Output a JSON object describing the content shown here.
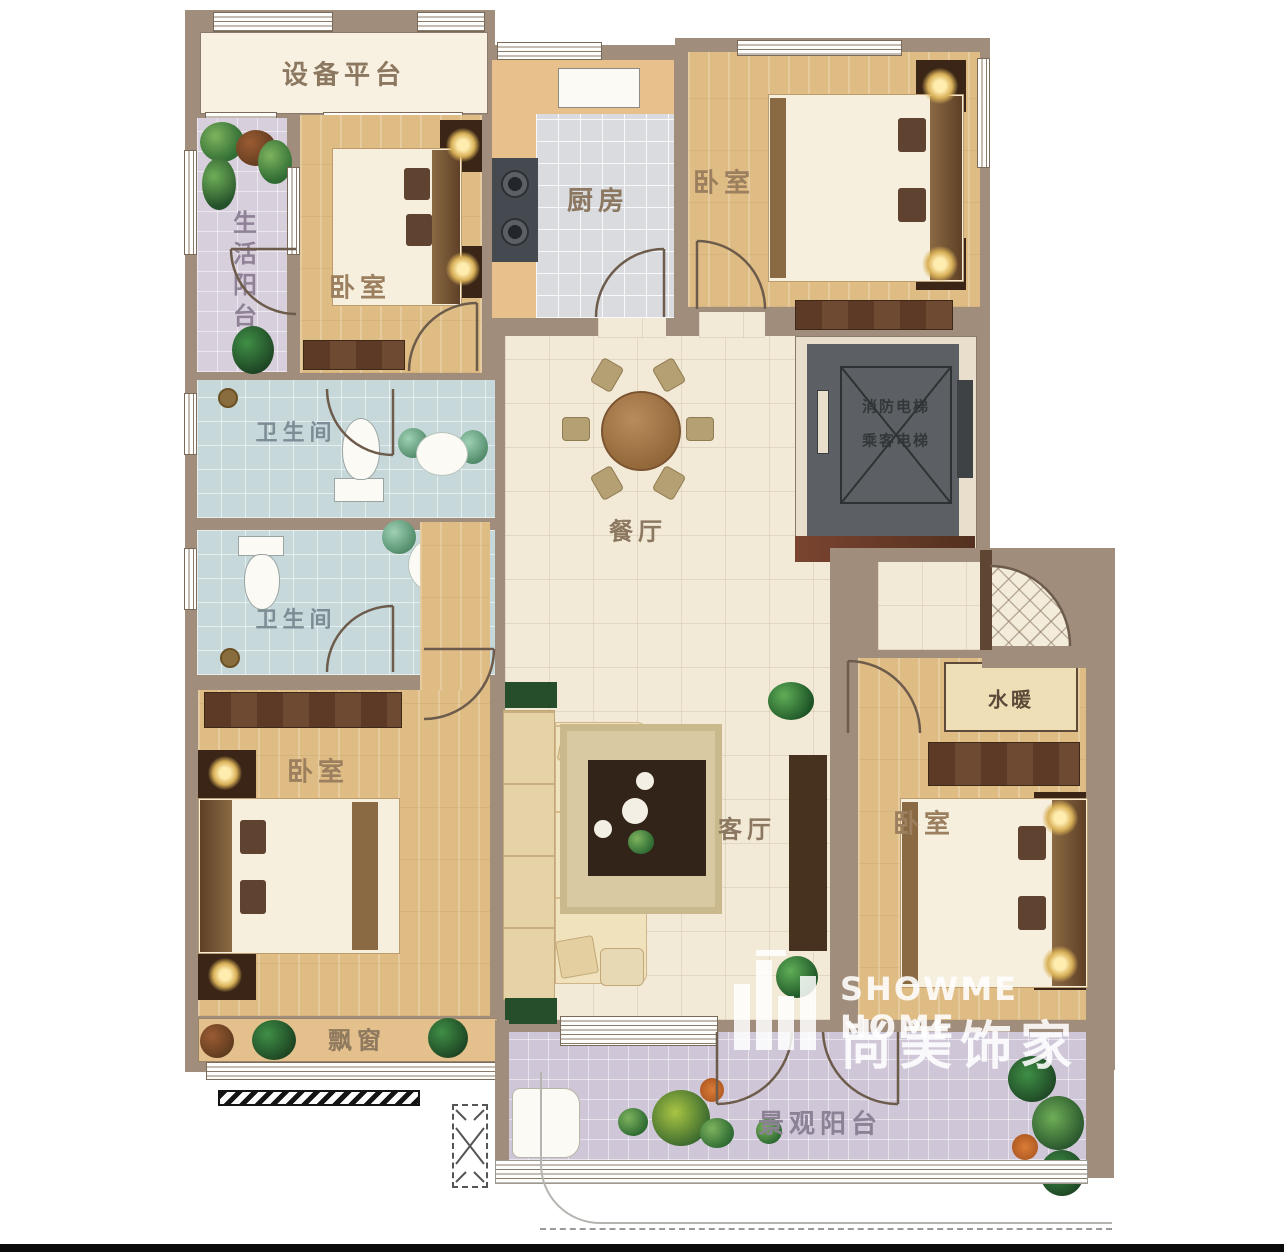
{
  "rooms": {
    "equipment_platform": "设备平台",
    "life_balcony": "生活阳台",
    "bedroom_top_left": "卧室",
    "kitchen": "厨房",
    "bedroom_top_right": "卧室",
    "bathroom_upper": "卫生间",
    "bathroom_lower": "卫生间",
    "dining": "餐厅",
    "foyer": "玄关",
    "plumbing": "水暖",
    "living": "客厅",
    "bedroom_bottom_left": "卧室",
    "bedroom_bottom_right": "卧室",
    "bay_window": "飘窗",
    "view_balcony": "景观阳台"
  },
  "elevator": {
    "line1": "消防电梯",
    "line2": "乘客电梯"
  },
  "watermark": {
    "en": "SHOWME HOME",
    "cn": "尚美饰家"
  },
  "colors": {
    "wall": "#a18d7b",
    "floor_cream": "#f2e9d6",
    "floor_wood": "#dfbc84",
    "tile_bath": "#c6d8da",
    "tile_kitchen": "#d9dbdf",
    "tile_balcony": "#cfc6d7",
    "elevator_gray": "#5c6064",
    "furniture_dark": "#5c3a26",
    "label_brown": "#8c7861",
    "plant_green": "#2f6b33"
  }
}
